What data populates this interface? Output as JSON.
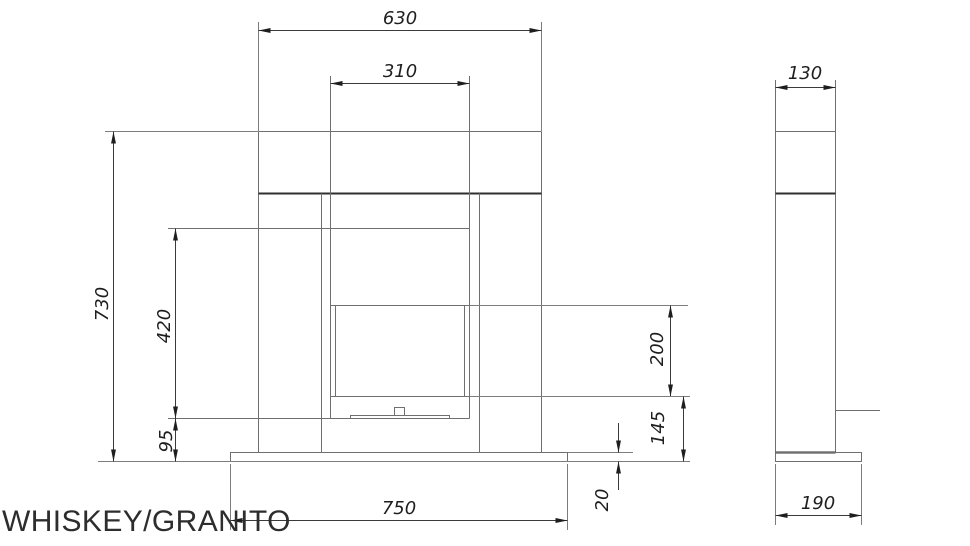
{
  "title": "WHISKEY/GRANITO",
  "front_view": {
    "dimensions": {
      "mantel_width": "630",
      "opening_width": "310",
      "total_height": "730",
      "opening_height": "420",
      "hearth_height": "95",
      "window_height": "200",
      "window_bottom_height": "145",
      "base_width": "750",
      "base_thickness": "20"
    }
  },
  "side_view": {
    "dimensions": {
      "body_depth": "130",
      "base_depth": "190"
    }
  },
  "colors": {
    "background": "#ffffff",
    "object_line": "#6f6f6f",
    "heavy_line": "#2f2f2f",
    "dimension_line": "#3a3a3a",
    "dimension_text": "#1e1e1e",
    "title_text": "#2d2d2d"
  }
}
